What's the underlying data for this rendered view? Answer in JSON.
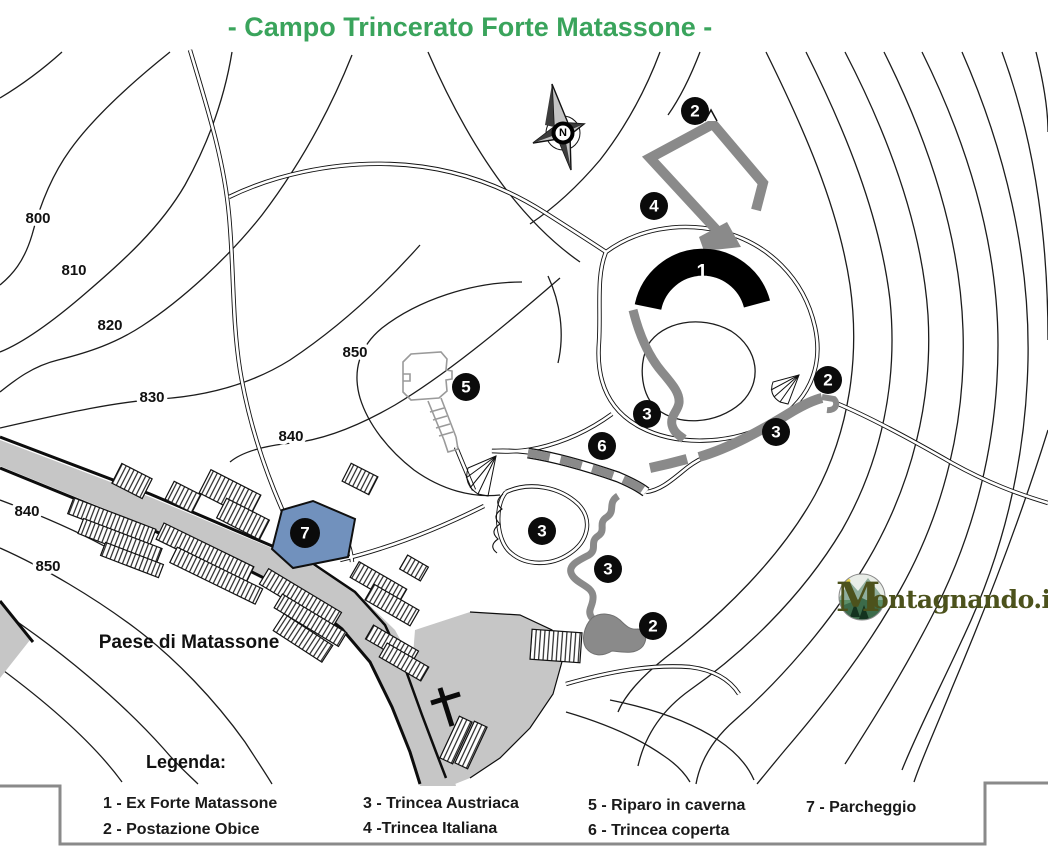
{
  "title": {
    "text": "- Campo Trincerato Forte Matassone -"
  },
  "colors": {
    "title_green": "#3aa45c",
    "parking_blue": "#7191bd",
    "trench_gray": "#8a8a8a",
    "road_gray": "#c6c6c6",
    "watermark_olive": "#4c521c",
    "legend_border_gray": "#8a8a8a"
  },
  "map": {
    "compass_label": "N",
    "village_label": "Paese di Matassone",
    "fort_number": "1",
    "contour_labels": [
      {
        "text": "800"
      },
      {
        "text": "810"
      },
      {
        "text": "820"
      },
      {
        "text": "830"
      },
      {
        "text": "840"
      },
      {
        "text": "850"
      },
      {
        "text": "840"
      },
      {
        "text": "850"
      }
    ],
    "markers": [
      {
        "number": "2"
      },
      {
        "number": "4"
      },
      {
        "number": "2"
      },
      {
        "number": "3"
      },
      {
        "number": "3"
      },
      {
        "number": "6"
      },
      {
        "number": "5"
      },
      {
        "number": "3"
      },
      {
        "number": "3"
      },
      {
        "number": "2"
      },
      {
        "number": "7"
      }
    ],
    "watermark": {
      "m": "M",
      "rest": "ontagnando.it"
    }
  },
  "legend": {
    "heading": "Legenda:",
    "items": [
      "1 - Ex Forte Matassone",
      "2 - Postazione Obice",
      "3 - Trincea Austriaca",
      "4 -Trincea Italiana",
      "5 - Riparo in caverna",
      "6 - Trincea coperta",
      "7 - Parcheggio"
    ]
  }
}
